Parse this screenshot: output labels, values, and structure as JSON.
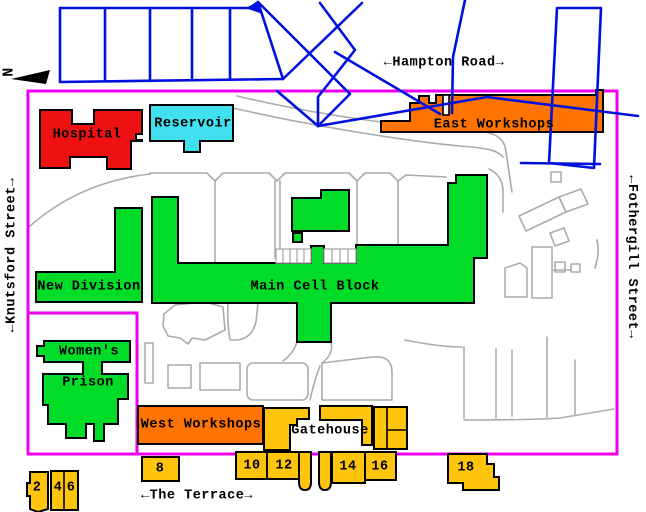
{
  "north": {
    "label": "N"
  },
  "streets": {
    "hampton_road": "←Hampton Road→",
    "knutsford_street": "←Knutsford Street→",
    "fothergill_street": "←Fothergill Street→",
    "the_terrace": "←The Terrace→"
  },
  "buildings": {
    "hospital": "Hospital",
    "reservoir": "Reservoir",
    "east_workshops": "East Workshops",
    "new_division": "New Division",
    "main_cell_block": "Main Cell Block",
    "womens_prison_line1": "Women's",
    "womens_prison_line2": "Prison",
    "west_workshops": "West Workshops",
    "gatehouse": "Gatehouse"
  },
  "terrace_numbers": [
    "2",
    "4",
    "6",
    "8",
    "10",
    "12",
    "14",
    "16",
    "18"
  ],
  "colors": {
    "boundary": "#EE00EE",
    "railway": "#0010DD",
    "hospital": "#EE1111",
    "reservoir": "#40E0EE",
    "workshops": "#FF7300",
    "prison_green": "#00DC28",
    "terrace_yellow": "#FFC40C",
    "path_gray": "#ABABAB",
    "outline": "#000000"
  }
}
